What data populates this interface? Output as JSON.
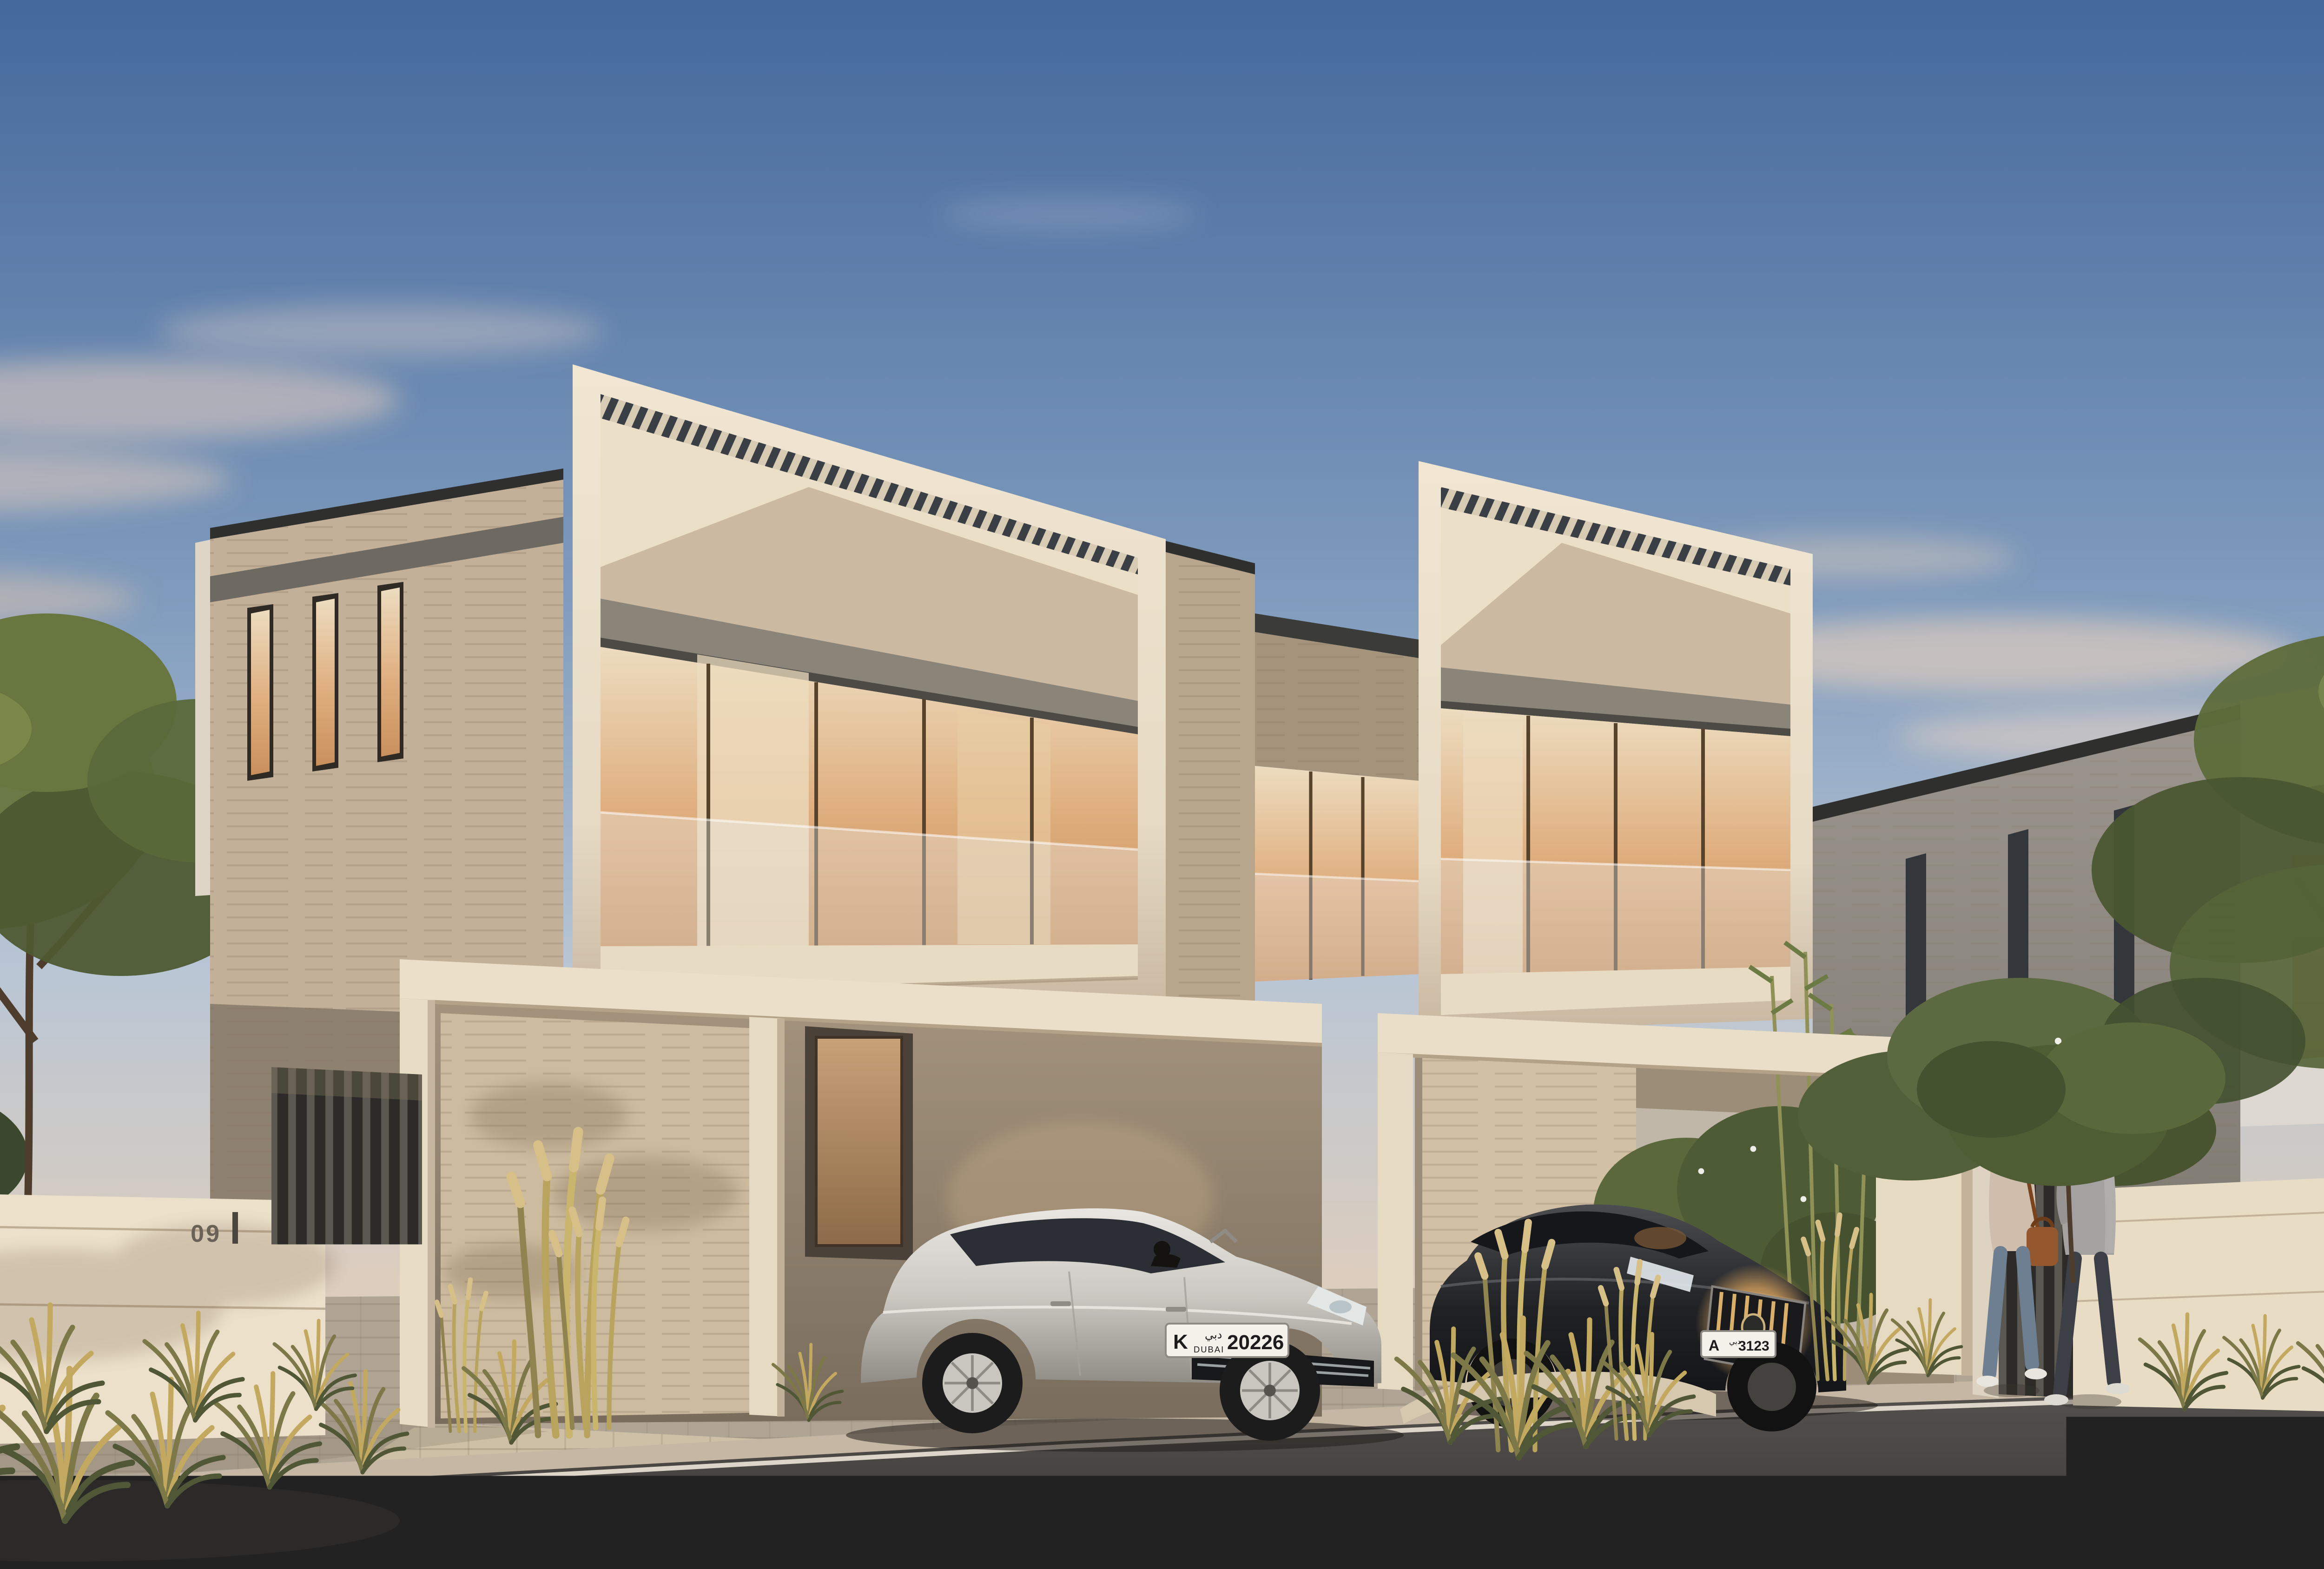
{
  "scene": {
    "type": "photorealistic architectural exterior rendering",
    "time_of_day": "dusk",
    "description": "Modern two-storey duplex villas with cream frame facades, travertine stone cladding, glass balconies glowing with warm interior light, covered carports with parked luxury cars, landscaped street at twilight",
    "location_hint": "Dubai residential community"
  },
  "signage": {
    "left_gate_number": "09",
    "right_gate_number": "11"
  },
  "vehicles": {
    "silver_sedan": {
      "name": "silver Porsche Panamera with driver inside",
      "license_plate": {
        "code_letter": "K",
        "city_arabic": "دبي",
        "city_latin": "DUBAI",
        "number": "20226"
      }
    },
    "grey_coupe": {
      "name": "grey Porsche 911 coupe"
    },
    "black_sedan": {
      "name": "black luxury sedan with illuminated vertical-bar grille",
      "license_plate": {
        "code_letter": "A",
        "city_arabic": "دبي",
        "number": "3123"
      }
    }
  },
  "people": {
    "woman": "woman in beige hoodie and jeans with tan shoulder bag walking away",
    "man": "man in grey blazer and dark trousers walking away"
  },
  "objects": {
    "bicycle": "white city bicycle with blue accents leaning on travertine wall",
    "left_gate": "dark vertical slat pedestrian gate",
    "pergola": "cream carport frames with dark roof louvers"
  },
  "colors": {
    "sky_top": "#44689c",
    "sky_mid": "#7f9bbd",
    "sky_low": "#b9c6d4",
    "horizon_warm": "#ddcdbd",
    "cloud_pink": "#ecd2bc",
    "cream_lit": "#f0e6d2",
    "cream": "#e6dac4",
    "cream_shade": "#c8b7a0",
    "louver_dark": "#3a3f45",
    "soffit_grey": "#8b8478",
    "band_dark": "#4b4a45",
    "parapet_dark": "#2f2f2d",
    "travertine": "#c2b098",
    "travertine_shade": "#998b75",
    "travertine_lit": "#d3c1a6",
    "glass_warm": "#dfae7e",
    "glass_amber": "#c9905c",
    "interior_cream": "#ecdcbf",
    "mullion_bronze": "#57422c",
    "balustrade_glass": "#e8edef",
    "villa_grey": "#9b958d",
    "villa_grey_dark": "#827d75",
    "white_frame": "#dcd8d1",
    "road_asphalt": "#4a4745",
    "curb_stone": "#c6b7a4",
    "curb_line": "#ddd5c8",
    "paver": "#b0a595",
    "driveway": "#cec0a7",
    "grass_gold": "#c3a95f",
    "grass_olive": "#7d7848",
    "grass_dark": "#4f5737",
    "tree_green": "#68763f",
    "tree_dark": "#47532f",
    "trunk_brown": "#5d4936",
    "car_silver": "#cbc8c2",
    "car_black": "#202225",
    "plate_white": "#f3f1ea",
    "plate_text": "#1c1c1c",
    "grille_glow": "#d8a35f"
  }
}
